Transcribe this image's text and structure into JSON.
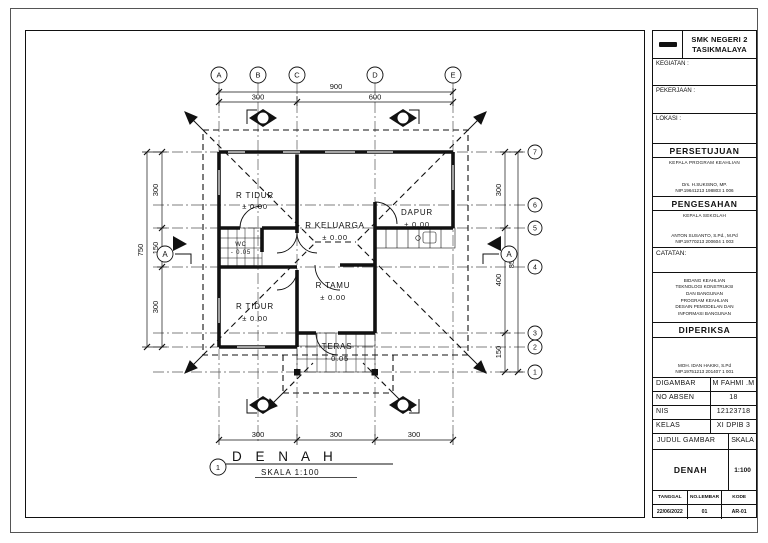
{
  "title_block": {
    "school_line1": "SMK NEGERI 2",
    "school_line2": "TASIKMALAYA",
    "kegiatan_label": "KEGIATAN :",
    "pekerjaan_label": "PEKERJAAN :",
    "lokasi_label": "LOKASI :",
    "persetujuan_header": "PERSETUJUAN",
    "persetujuan_role": "KEPALA PROGRAM KEAHLIAN",
    "persetujuan_name": "Drs. H.SUKISNO, MP.",
    "persetujuan_nip": "NIP.19641213 198803 1 006",
    "pengesahan_header": "PENGESAHAN",
    "pengesahan_role": "KEPALA SEKOLAH",
    "pengesahan_name": "ANTON SUSANTO, S.Pd., M.Pd",
    "pengesahan_nip": "NIP.19770213 200604 1 003",
    "catatan_label": "CATATAN:",
    "bidang_lines": [
      "BIDANG KEAHLIAN",
      "TEKNOLOGI KONSTRUKSI",
      "DAN BANGUNAN",
      "PROGRAM KEAHLIAN",
      "DESAIN PEMODELAN DAN",
      "INFORMASI BANGUNAN"
    ],
    "diperiksa_header": "DIPERIKSA",
    "diperiksa_name": "MOH. IDAN HAKIKI, S.Pd",
    "diperiksa_nip": "NIP.19751213 201407 1 001",
    "digambar_label": "DIGAMBAR",
    "digambar_value": "M FAHMI .M",
    "no_absen_label": "NO ABSEN",
    "no_absen_value": "18",
    "nis_label": "NIS",
    "nis_value": "12123718",
    "kelas_label": "KELAS",
    "kelas_value": "XI DPIB 3",
    "judul_gambar_label": "JUDUL GAMBAR",
    "skala_label": "SKALA",
    "judul_value": "DENAH",
    "skala_value": "1:100",
    "tanggal_label": "TANGGAL",
    "no_lembar_label": "NO.LEMBAR",
    "kode_label": "KODE",
    "tanggal_value": "22/06/2022",
    "no_lembar_value": "01",
    "kode_value": "AR-01"
  },
  "plan": {
    "grid_cols": [
      "A",
      "B",
      "C",
      "D",
      "E"
    ],
    "grid_rows": [
      "7",
      "6",
      "5",
      "4",
      "3",
      "2",
      "1"
    ],
    "dims": {
      "top_overall": "900",
      "top_segments": [
        "300",
        "600"
      ],
      "bottom_segments": [
        "300",
        "300",
        "300"
      ],
      "left_overall": "750",
      "left_segments": [
        "300",
        "150",
        "300"
      ],
      "right_overall": "850",
      "right_segments": [
        "300",
        "400",
        "150"
      ]
    },
    "rooms": {
      "tidur_atas": {
        "name": "R TIDUR",
        "elev": "± 0.00"
      },
      "keluarga": {
        "name": "R KELUARGA",
        "elev": "± 0.00"
      },
      "dapur": {
        "name": "DAPUR",
        "elev": "± 0.00"
      },
      "wc": {
        "name": "WC",
        "elev": "- 0.05"
      },
      "tidur_bawah": {
        "name": "R TIDUR",
        "elev": "± 0.00"
      },
      "tamu": {
        "name": "R TAMU",
        "elev": "± 0.00"
      },
      "teras": {
        "name": "TERAS",
        "elev": "- 0.05"
      }
    },
    "section_mark": "A",
    "title": {
      "number": "1",
      "text": "D E N A H",
      "scale": "SKALA 1:100"
    }
  }
}
